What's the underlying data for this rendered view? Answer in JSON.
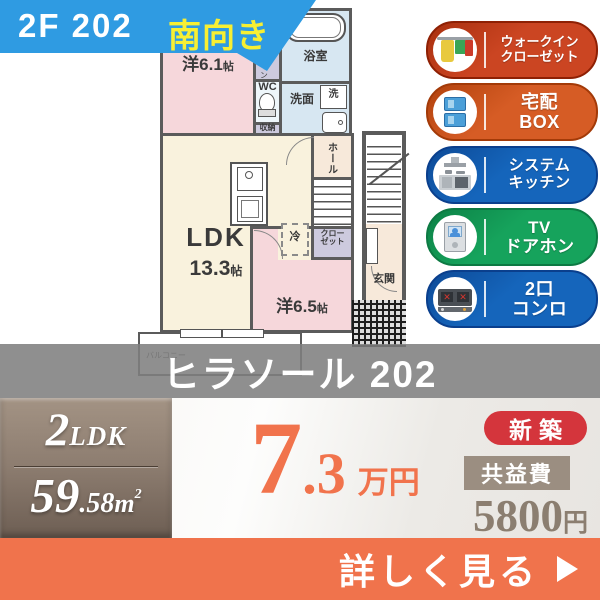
{
  "header": {
    "unit": "2F 202",
    "facing": "南向き"
  },
  "building": {
    "name": "ヒラソール 202"
  },
  "floorplan": {
    "rooms": {
      "western1": {
        "name": "洋6.1",
        "unit": "帖"
      },
      "western2": {
        "name": "洋6.5",
        "unit": "帖"
      },
      "ldk": {
        "name": "LDK",
        "size": "13.3",
        "unit": "帖"
      },
      "bath": "浴室",
      "washroom": "洗面",
      "washer": "洗",
      "wc": "WC",
      "storage": "収納",
      "walkin_closet": "ウォークイン",
      "hall": "ホール",
      "closet_line1": "クロー",
      "closet_line2": "ゼット",
      "fridge": "冷",
      "entrance": "玄関",
      "balcony": "バルコニー"
    }
  },
  "features": [
    {
      "line1": "ウォークイン",
      "line2": "クローゼット",
      "bg": "#cb4522",
      "bg2": "#a82f0e",
      "border": "#8e2004",
      "icon": "walk-in-closet"
    },
    {
      "line1": "宅配",
      "line2": "BOX",
      "bg": "#d65c25",
      "bg2": "#b2420d",
      "border": "#a33a08",
      "icon": "delivery-box"
    },
    {
      "line1": "システム",
      "line2": "キッチン",
      "bg": "#1565bb",
      "bg2": "#0d4a97",
      "border": "#0a3f8d",
      "icon": "system-kitchen"
    },
    {
      "line1": "TV",
      "line2": "ドアホン",
      "bg": "#16a35c",
      "bg2": "#0c8146",
      "border": "#0d7a43",
      "icon": "tv-doorphone"
    },
    {
      "line1": "2口",
      "line2": "コンロ",
      "bg": "#1565bb",
      "bg2": "#0d4a97",
      "border": "#0a3f8d",
      "icon": "two-burner-stove"
    }
  ],
  "summary": {
    "layout_num": "2",
    "layout_type": "LDK",
    "area_int": "59",
    "area_dec": ".58",
    "area_unit": "m",
    "area_sup": "2",
    "rent_int": "7",
    "rent_dec": ".3",
    "rent_unit": "万円",
    "new_badge": "新築",
    "fee_label": "共益費",
    "fee_value": "5800",
    "fee_unit": "円",
    "cta": "詳しく見る"
  },
  "colors": {
    "banner_blue": "#2f9be2",
    "facing_yellow": "#f7ef33",
    "name_band_gray": "#7e7e7e",
    "accent_orange": "#f0734c",
    "new_badge_red": "#d4353c",
    "fee_bar_taupe": "#9b8e81",
    "layout_box_taupe": "#8d7d70",
    "wall_gray": "#5b5b5b",
    "room_pink": "#f6d7db",
    "room_blue": "#d7e7f2",
    "room_cream": "#f9f2dd",
    "room_peach": "#f7e9da",
    "room_lavender": "#cdcade"
  }
}
